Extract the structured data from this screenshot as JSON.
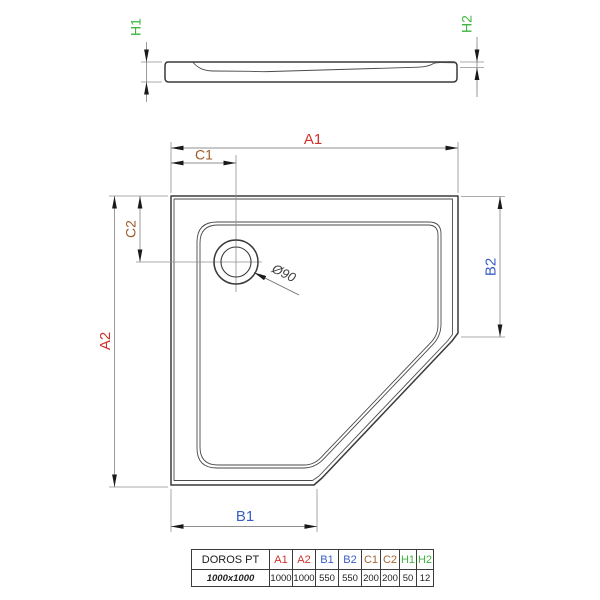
{
  "drawing": {
    "dim_labels": {
      "a1": "A1",
      "a2": "A2",
      "b1": "B1",
      "b2": "B2",
      "c1": "C1",
      "c2": "C2",
      "h1": "H1",
      "h2": "H2"
    },
    "drain_label": "Ø90",
    "colors": {
      "a": "#d0322b",
      "b": "#3a5fc4",
      "c": "#9e5a28",
      "h": "#3cb53c",
      "dim": "#8f8f8f",
      "arrow": "#1a1a1a"
    }
  },
  "table": {
    "model": "DOROS PT",
    "size_label": "1000x1000",
    "headers": [
      {
        "label": "A1",
        "color": "#d0322b"
      },
      {
        "label": "A2",
        "color": "#d0322b"
      },
      {
        "label": "B1",
        "color": "#3a5fc4"
      },
      {
        "label": "B2",
        "color": "#3a5fc4"
      },
      {
        "label": "C1",
        "color": "#a56433"
      },
      {
        "label": "C2",
        "color": "#a56433"
      },
      {
        "label": "H1",
        "color": "#3cb53c"
      },
      {
        "label": "H2",
        "color": "#3cb53c"
      }
    ],
    "values": [
      "1000",
      "1000",
      "550",
      "550",
      "200",
      "200",
      "50",
      "12"
    ]
  }
}
